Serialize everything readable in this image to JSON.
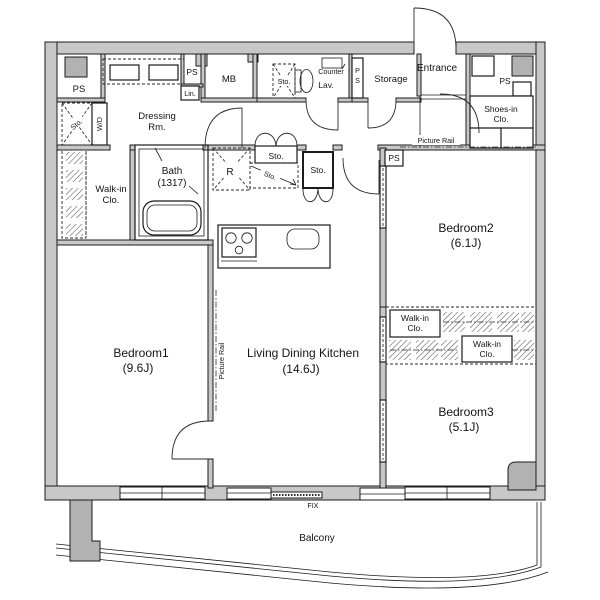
{
  "plan": {
    "type": "apartment-floor-plan",
    "colors": {
      "wall": "#c8c8c8",
      "column": "#b2b2b2",
      "line": "#1b1b1b",
      "background": "#ffffff"
    },
    "rooms": {
      "bedroom1": {
        "name": "Bedroom1",
        "size": "(9.6J)"
      },
      "bedroom2": {
        "name": "Bedroom2",
        "size": "(6.1J)"
      },
      "bedroom3": {
        "name": "Bedroom3",
        "size": "(5.1J)"
      },
      "ldk": {
        "name": "Living Dining Kitchen",
        "size": "(14.6J)"
      },
      "bath": {
        "name": "Bath",
        "size": "(1317)"
      },
      "entrance": {
        "name": "Entrance"
      },
      "storage": {
        "name": "Storage"
      },
      "lav": {
        "name": "Lav."
      },
      "dressing": {
        "line1": "Dressing",
        "line2": "Rm."
      },
      "balcony": {
        "name": "Balcony"
      }
    },
    "labels": {
      "ps": "PS",
      "p": "P",
      "s": "S",
      "mb": "MB",
      "lin": "Lin.",
      "sto": "Sto.",
      "wd": "W/D",
      "counter": "Counter",
      "r": "R",
      "fix": "FIX",
      "picture_rail": "Picture Rail",
      "walkin1": "Walk-in",
      "walkin2": "Clo.",
      "shoes1": "Shoes-in",
      "shoes2": "Clo."
    }
  }
}
